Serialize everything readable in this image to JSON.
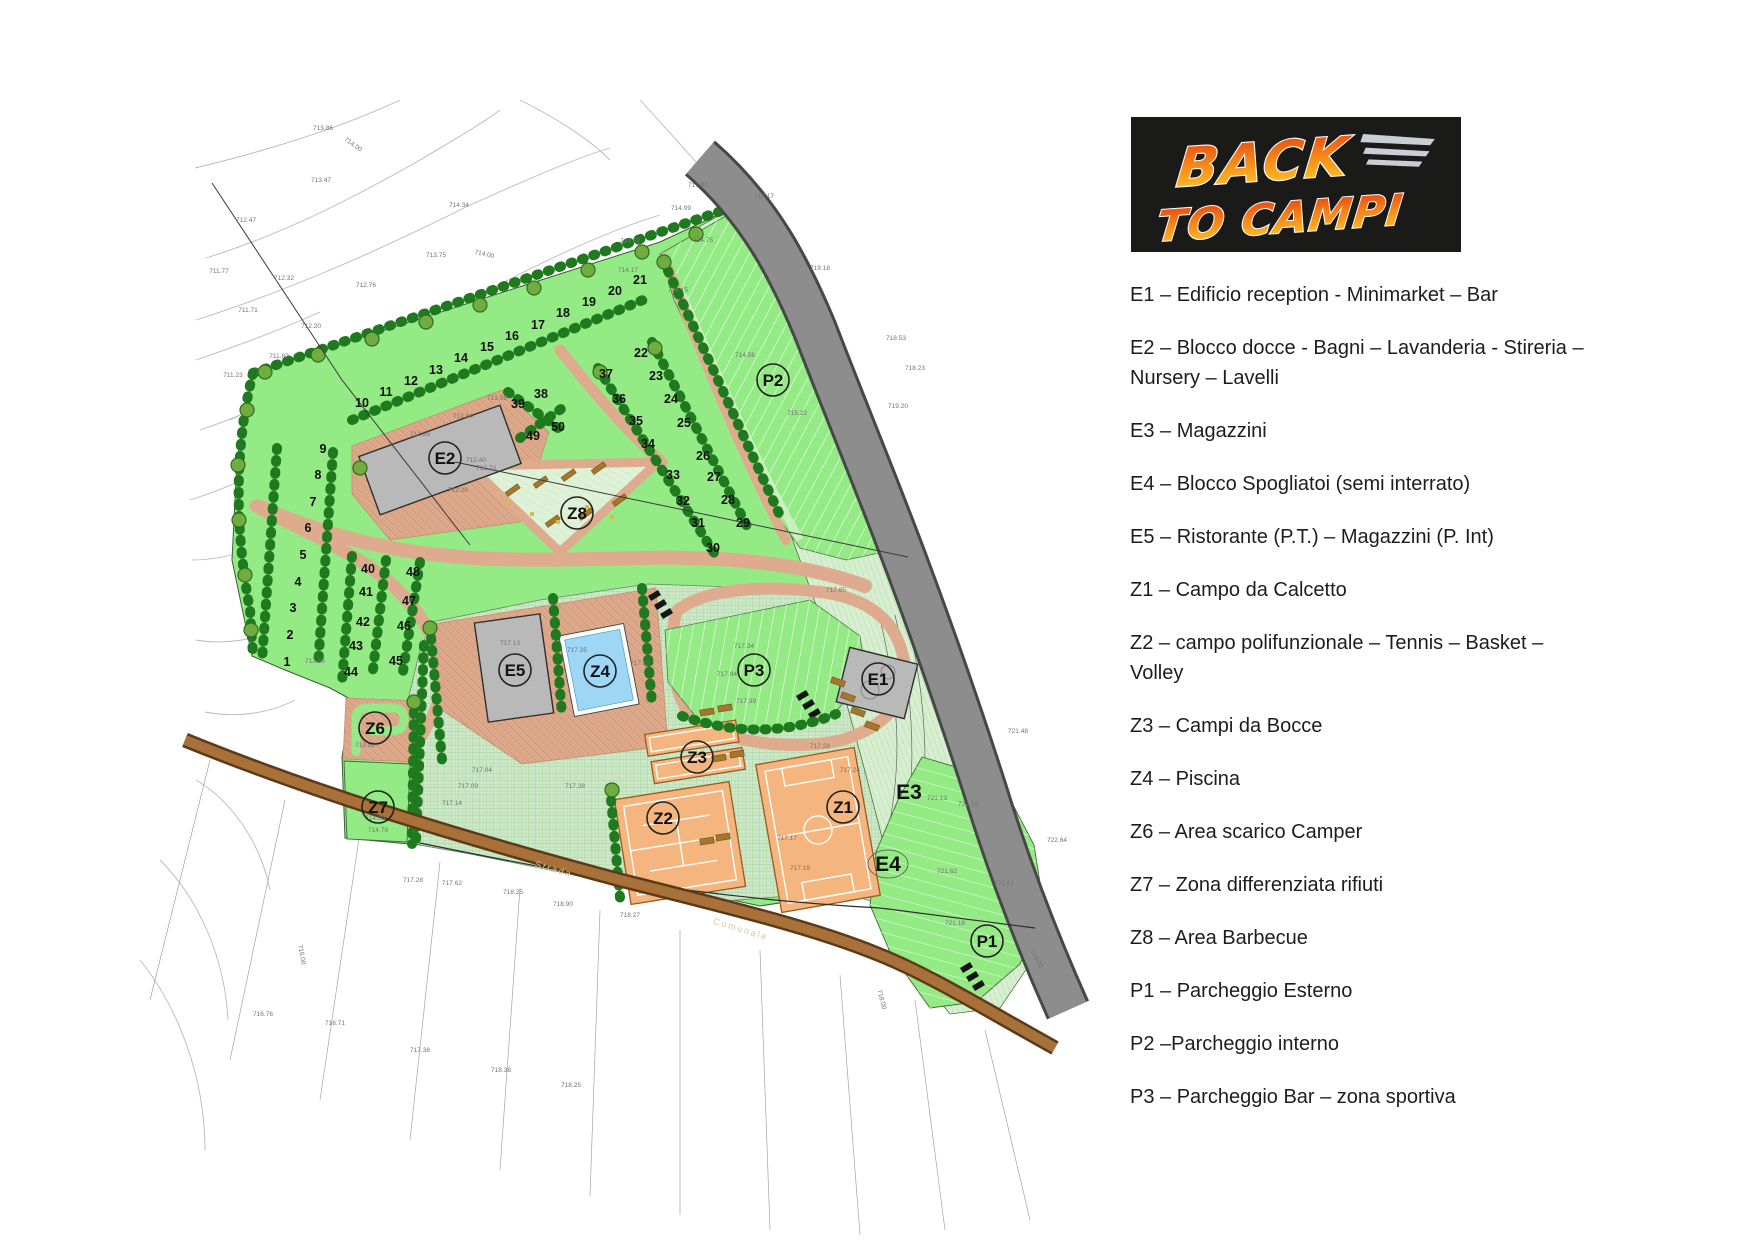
{
  "logo": {
    "word1": "BACK",
    "word2": "TO CAMPI"
  },
  "legend": {
    "items": [
      "E1 – Edificio reception  - Minimarket – Bar",
      "E2 – Blocco docce - Bagni – Lavanderia - Stireria – Nursery – Lavelli",
      "E3 – Magazzini",
      "E4 – Blocco Spogliatoi (semi interrato)",
      "E5 – Ristorante (P.T.) – Magazzini (P. Int)",
      "Z1 – Campo da Calcetto",
      "Z2 – campo polifunzionale – Tennis – Basket – Volley",
      "Z3 – Campi da Bocce",
      "Z4 – Piscina",
      "Z6 – Area scarico Camper",
      "Z7 – Zona differenziata rifiuti",
      "Z8 – Area Barbecue",
      "P1 – Parcheggio Esterno",
      "P2 –Parcheggio interno",
      "P3 – Parcheggio Bar – zona sportiva"
    ]
  },
  "map": {
    "zone_labels": [
      {
        "id": "E2"
      },
      {
        "id": "Z8"
      },
      {
        "id": "P2"
      },
      {
        "id": "E5"
      },
      {
        "id": "Z4"
      },
      {
        "id": "P3"
      },
      {
        "id": "E1"
      },
      {
        "id": "Z3"
      },
      {
        "id": "Z2"
      },
      {
        "id": "Z1"
      },
      {
        "id": "Z6"
      },
      {
        "id": "Z7"
      },
      {
        "id": "P1"
      }
    ],
    "area_labels": [
      {
        "id": "E3"
      },
      {
        "id": "E4"
      }
    ],
    "pitch_numbers": [
      {
        "label": "1",
        "x": 287,
        "y": 666
      },
      {
        "label": "2",
        "x": 290,
        "y": 639
      },
      {
        "label": "3",
        "x": 293,
        "y": 612
      },
      {
        "label": "4",
        "x": 298,
        "y": 586
      },
      {
        "label": "5",
        "x": 303,
        "y": 559
      },
      {
        "label": "6",
        "x": 308,
        "y": 532
      },
      {
        "label": "7",
        "x": 313,
        "y": 506
      },
      {
        "label": "8",
        "x": 318,
        "y": 479
      },
      {
        "label": "9",
        "x": 323,
        "y": 453
      },
      {
        "label": "10",
        "x": 362,
        "y": 407
      },
      {
        "label": "11",
        "x": 386,
        "y": 396
      },
      {
        "label": "12",
        "x": 411,
        "y": 385
      },
      {
        "label": "13",
        "x": 436,
        "y": 374
      },
      {
        "label": "14",
        "x": 461,
        "y": 362
      },
      {
        "label": "15",
        "x": 487,
        "y": 351
      },
      {
        "label": "16",
        "x": 512,
        "y": 340
      },
      {
        "label": "17",
        "x": 538,
        "y": 329
      },
      {
        "label": "18",
        "x": 563,
        "y": 317
      },
      {
        "label": "19",
        "x": 589,
        "y": 306
      },
      {
        "label": "20",
        "x": 615,
        "y": 295
      },
      {
        "label": "21",
        "x": 640,
        "y": 284
      },
      {
        "label": "22",
        "x": 641,
        "y": 357
      },
      {
        "label": "23",
        "x": 656,
        "y": 380
      },
      {
        "label": "24",
        "x": 671,
        "y": 403
      },
      {
        "label": "25",
        "x": 684,
        "y": 427
      },
      {
        "label": "26",
        "x": 703,
        "y": 460
      },
      {
        "label": "27",
        "x": 714,
        "y": 481
      },
      {
        "label": "28",
        "x": 728,
        "y": 504
      },
      {
        "label": "29",
        "x": 743,
        "y": 527
      },
      {
        "label": "30",
        "x": 713,
        "y": 552
      },
      {
        "label": "31",
        "x": 698,
        "y": 527
      },
      {
        "label": "32",
        "x": 683,
        "y": 505
      },
      {
        "label": "33",
        "x": 673,
        "y": 479
      },
      {
        "label": "34",
        "x": 648,
        "y": 448
      },
      {
        "label": "35",
        "x": 636,
        "y": 425
      },
      {
        "label": "36",
        "x": 619,
        "y": 403
      },
      {
        "label": "37",
        "x": 606,
        "y": 378
      },
      {
        "label": "38",
        "x": 541,
        "y": 398
      },
      {
        "label": "39",
        "x": 518,
        "y": 408
      },
      {
        "label": "40",
        "x": 368,
        "y": 573
      },
      {
        "label": "41",
        "x": 366,
        "y": 596
      },
      {
        "label": "42",
        "x": 363,
        "y": 626
      },
      {
        "label": "43",
        "x": 356,
        "y": 650
      },
      {
        "label": "44",
        "x": 351,
        "y": 676
      },
      {
        "label": "45",
        "x": 396,
        "y": 665
      },
      {
        "label": "46",
        "x": 404,
        "y": 630
      },
      {
        "label": "47",
        "x": 409,
        "y": 605
      },
      {
        "label": "48",
        "x": 413,
        "y": 576
      },
      {
        "label": "49",
        "x": 533,
        "y": 440
      },
      {
        "label": "50",
        "x": 558,
        "y": 431
      }
    ],
    "elevation_labels": [
      {
        "label": "713.86",
        "x": 323,
        "y": 130
      },
      {
        "label": "714.00",
        "x": 352,
        "y": 146,
        "r": 35
      },
      {
        "label": "713.47",
        "x": 321,
        "y": 182
      },
      {
        "label": "714.34",
        "x": 459,
        "y": 207
      },
      {
        "label": "712.47",
        "x": 246,
        "y": 222
      },
      {
        "label": "713.75",
        "x": 436,
        "y": 257
      },
      {
        "label": "712.76",
        "x": 366,
        "y": 287
      },
      {
        "label": "711.77",
        "x": 219,
        "y": 273
      },
      {
        "label": "712.32",
        "x": 284,
        "y": 280
      },
      {
        "label": "711.71",
        "x": 248,
        "y": 312
      },
      {
        "label": "712.20",
        "x": 311,
        "y": 328
      },
      {
        "label": "711.82",
        "x": 279,
        "y": 358
      },
      {
        "label": "711.23",
        "x": 233,
        "y": 377
      },
      {
        "label": "717.02",
        "x": 698,
        "y": 187
      },
      {
        "label": "714.99",
        "x": 681,
        "y": 210
      },
      {
        "label": "714.58",
        "x": 630,
        "y": 243
      },
      {
        "label": "714.00",
        "x": 484,
        "y": 256,
        "r": 12
      },
      {
        "label": "714.75",
        "x": 703,
        "y": 242
      },
      {
        "label": "714.17",
        "x": 628,
        "y": 272
      },
      {
        "label": "714.15",
        "x": 678,
        "y": 292
      },
      {
        "label": "718.17",
        "x": 764,
        "y": 198
      },
      {
        "label": "719.18",
        "x": 820,
        "y": 270
      },
      {
        "label": "718.53",
        "x": 896,
        "y": 340
      },
      {
        "label": "718.23",
        "x": 915,
        "y": 370
      },
      {
        "label": "719.20",
        "x": 898,
        "y": 408
      },
      {
        "label": "714.56",
        "x": 745,
        "y": 357
      },
      {
        "label": "715.22",
        "x": 797,
        "y": 415
      },
      {
        "label": "712.84",
        "x": 463,
        "y": 418
      },
      {
        "label": "712.26",
        "x": 420,
        "y": 436
      },
      {
        "label": "713.58",
        "x": 497,
        "y": 400
      },
      {
        "label": "712.40",
        "x": 476,
        "y": 462
      },
      {
        "label": "712.73",
        "x": 486,
        "y": 470
      },
      {
        "label": "712.26",
        "x": 458,
        "y": 492
      },
      {
        "label": "712.85",
        "x": 315,
        "y": 663
      },
      {
        "label": "713.92",
        "x": 365,
        "y": 747
      },
      {
        "label": "717.13",
        "x": 510,
        "y": 645
      },
      {
        "label": "717.35",
        "x": 577,
        "y": 652
      },
      {
        "label": "717.33",
        "x": 640,
        "y": 665
      },
      {
        "label": "717.04",
        "x": 482,
        "y": 772
      },
      {
        "label": "717.09",
        "x": 468,
        "y": 788
      },
      {
        "label": "717.28",
        "x": 575,
        "y": 788
      },
      {
        "label": "717.14",
        "x": 452,
        "y": 805
      },
      {
        "label": "714.09",
        "x": 375,
        "y": 820
      },
      {
        "label": "714.79",
        "x": 378,
        "y": 832
      },
      {
        "label": "717.28",
        "x": 413,
        "y": 882
      },
      {
        "label": "717.62",
        "x": 452,
        "y": 885
      },
      {
        "label": "718.25",
        "x": 513,
        "y": 894
      },
      {
        "label": "718.90",
        "x": 563,
        "y": 906
      },
      {
        "label": "718.27",
        "x": 630,
        "y": 917
      },
      {
        "label": "716.76",
        "x": 263,
        "y": 1016
      },
      {
        "label": "716.71",
        "x": 335,
        "y": 1025
      },
      {
        "label": "717.38",
        "x": 420,
        "y": 1052
      },
      {
        "label": "718.38",
        "x": 501,
        "y": 1072
      },
      {
        "label": "718.25",
        "x": 571,
        "y": 1087
      },
      {
        "label": "721.13",
        "x": 937,
        "y": 800
      },
      {
        "label": "722.18",
        "x": 968,
        "y": 806
      },
      {
        "label": "721.62",
        "x": 947,
        "y": 873
      },
      {
        "label": "721.81",
        "x": 1004,
        "y": 885
      },
      {
        "label": "721.18",
        "x": 955,
        "y": 925
      },
      {
        "label": "721.48",
        "x": 1018,
        "y": 733
      },
      {
        "label": "722.64",
        "x": 1057,
        "y": 842
      },
      {
        "label": "717.65",
        "x": 836,
        "y": 592
      },
      {
        "label": "717.34",
        "x": 744,
        "y": 648
      },
      {
        "label": "717.94",
        "x": 727,
        "y": 676
      },
      {
        "label": "717.39",
        "x": 746,
        "y": 703
      },
      {
        "label": "717.28",
        "x": 820,
        "y": 748
      },
      {
        "label": "717.17",
        "x": 787,
        "y": 840
      },
      {
        "label": "717.19",
        "x": 800,
        "y": 870
      },
      {
        "label": "717.24",
        "x": 850,
        "y": 772
      },
      {
        "label": "716.00",
        "x": 300,
        "y": 955,
        "r": 80
      },
      {
        "label": "718.00",
        "x": 880,
        "y": 1000,
        "r": 75
      },
      {
        "label": "720.00",
        "x": 1035,
        "y": 960,
        "r": 60
      }
    ],
    "road_labels": [
      {
        "label": "Strada",
        "x": 553,
        "y": 872,
        "r": 16
      },
      {
        "label": "Comunale",
        "x": 740,
        "y": 932,
        "r": 17
      }
    ]
  }
}
